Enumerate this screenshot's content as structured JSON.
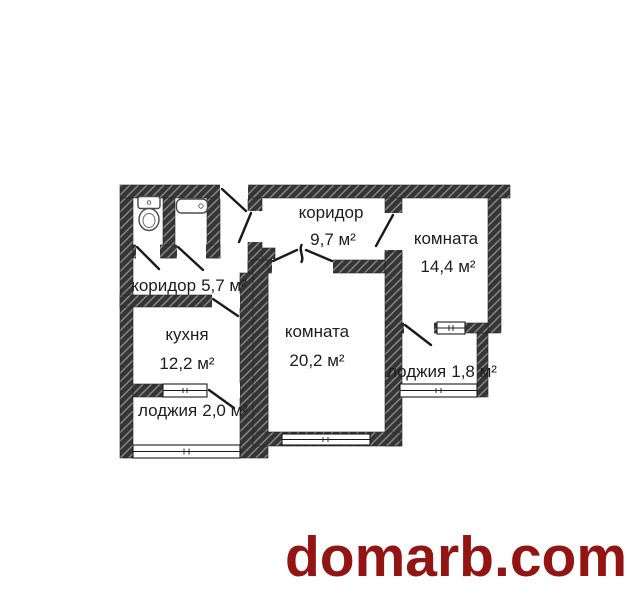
{
  "floor_plan": {
    "type": "apartment-floor-plan",
    "rooms": {
      "corridor_top": {
        "name": "коридор",
        "area": "9,7 м²"
      },
      "room_top_right": {
        "name": "комната",
        "area": "14,4 м²"
      },
      "corridor_small": {
        "name": "коридор",
        "area": "5,7 м²"
      },
      "kitchen": {
        "name": "кухня",
        "area": "12,2 м²"
      },
      "room_center": {
        "name": "комната",
        "area": "20,2 м²"
      },
      "loggia_right": {
        "name": "лоджия",
        "area": "1,8 м²"
      },
      "loggia_bottom": {
        "name": "лоджия",
        "area": "2,0 м²"
      }
    },
    "fixtures": [
      "toilet-icon",
      "bathtub-icon"
    ],
    "colors": {
      "wall": "#353535",
      "wall_hatch_line": "#8a8a8a",
      "background": "#ffffff",
      "label_text": "#1d1d1d"
    }
  },
  "watermark": {
    "text": "domarb.com",
    "color": "#921413"
  }
}
